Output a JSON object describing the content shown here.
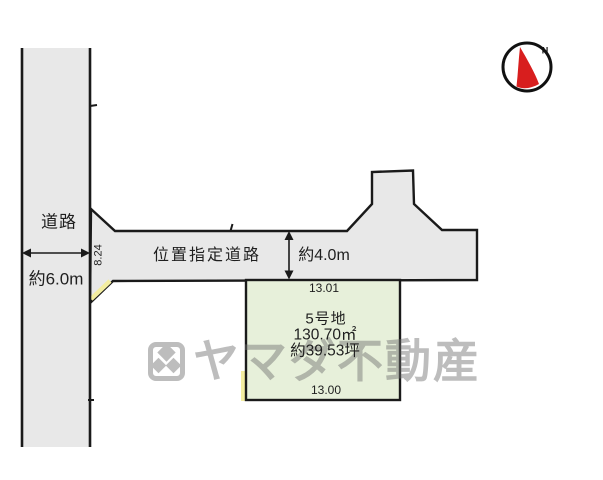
{
  "colors": {
    "road_fill": "#e8e8e8",
    "plot_fill": "#e7f0da",
    "line": "#1a1a1a",
    "highlight_yellow": "#f3eda0",
    "compass_red": "#d81e1e",
    "watermark_gray": "#6e6e6e"
  },
  "roads": {
    "main_road": {
      "label": "道路",
      "width_label": "約6.0m",
      "edge_dimension": "8.24"
    },
    "designated_road": {
      "label": "位置指定道路",
      "width_label": "約4.0m"
    }
  },
  "plot": {
    "name": "5号地",
    "area_sqm": "130.70㎡",
    "area_tsubo": "約39.53坪",
    "north_dimension": "13.01",
    "south_dimension": "13.00"
  },
  "compass": {
    "north_label": "N"
  },
  "watermark": {
    "company": "ヤマダ不動産"
  }
}
